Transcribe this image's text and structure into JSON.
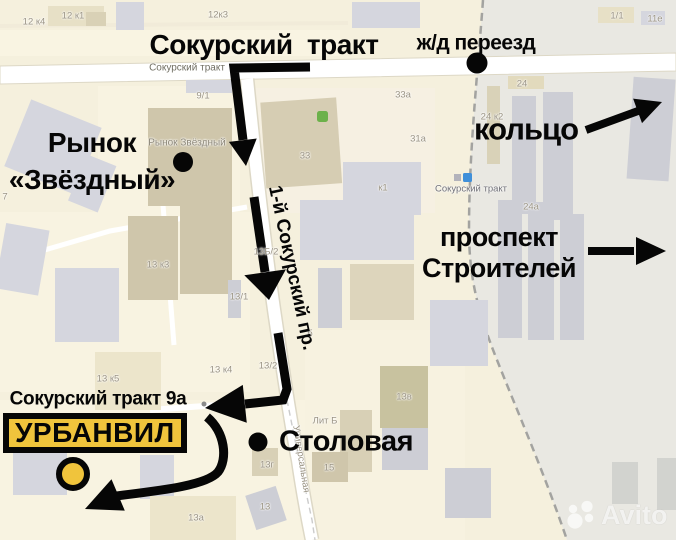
{
  "annotations": {
    "main_road": "Сокурский тракт",
    "railway_crossing": "ж/д переезд",
    "ring": "кольцо",
    "market_line1": "Рынок",
    "market_line2": "«Звёздный»",
    "prospekt_line1": "проспект",
    "prospekt_line2": "Строителей",
    "side_street": "1-й Сокурский пр.",
    "address": "Сокурский тракт 9а",
    "destination": "УРБАНВИЛ",
    "canteen": "Столовая"
  },
  "map_labels": {
    "road_top": "Сокурский тракт",
    "bus_stop": "Сокурский тракт",
    "street_universalnaya": "Универсальная",
    "poi_market": "Рынок Звёздный",
    "buildings": [
      "12 к4",
      "12 к1",
      "12к3",
      "1/1",
      "11е",
      "9/1",
      "33а",
      "31а",
      "33",
      "к1",
      "24",
      "24 к2",
      "24а",
      "7",
      "13 к3",
      "13/1",
      "13Б/2",
      "б",
      "13/2",
      "13 к4",
      "13 к5",
      "Лит Б",
      "13г",
      "15",
      "13",
      "13а",
      "13в"
    ]
  },
  "watermark": {
    "brand": "Avito"
  },
  "colors": {
    "accent_yellow": "#f0c43c",
    "route_black": "#060606",
    "map_beige": "#f5f0dd",
    "industrial_gray": "#e9e8e2"
  }
}
